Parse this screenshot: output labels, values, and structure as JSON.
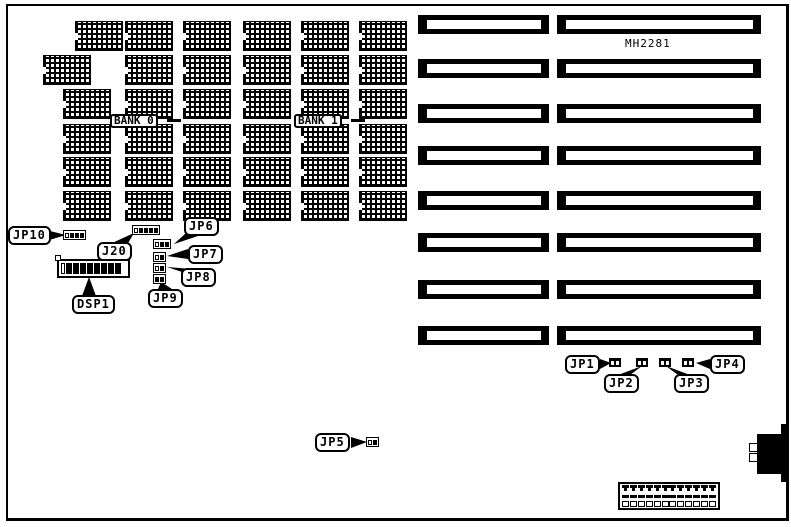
{
  "board": {
    "model": "MH2281"
  },
  "banks": {
    "bank0": "BANK 0",
    "bank1": "BANK 1"
  },
  "callouts": {
    "jp10": "JP10",
    "j20": "J20",
    "jp6": "JP6",
    "jp7": "JP7",
    "jp8": "JP8",
    "jp9": "JP9",
    "dsp1": "DSP1",
    "jp5": "JP5",
    "jp1": "JP1",
    "jp2": "JP2",
    "jp3": "JP3",
    "jp4": "JP4"
  },
  "counts": {
    "memory_chips": 36,
    "expansion_slot_rows": 8,
    "bottom_connector_pins": 12
  },
  "colors": {
    "ink": "#000000",
    "paper": "#ffffff"
  }
}
